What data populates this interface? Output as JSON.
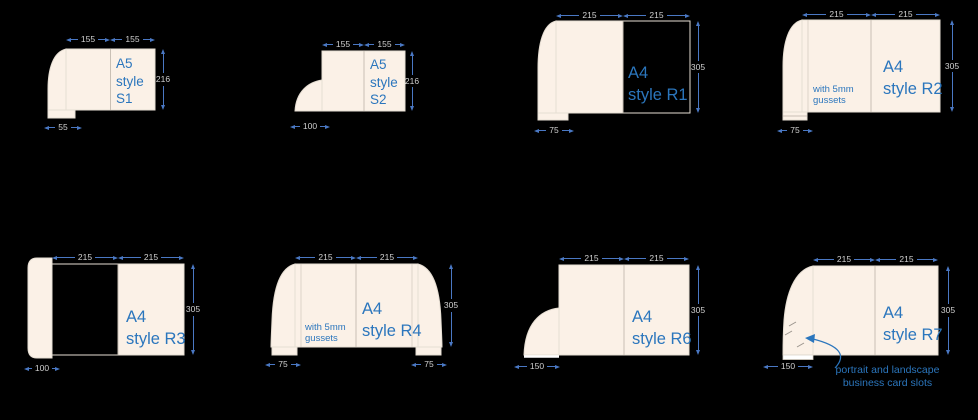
{
  "title": "presentation folder style diagrams",
  "colors": {
    "background": "#000000",
    "panel_fill": "#fbf1e7",
    "panel_outline": "#e6ded3",
    "label_text": "#2b76bd",
    "dimension_line": "#4a78c4",
    "dimension_text": "#d0d0d0"
  },
  "diagrams": [
    {
      "id": "S1",
      "label_lines": [
        "A5",
        "style",
        "S1"
      ],
      "top_dims": [
        "155",
        "155"
      ],
      "height_dim": "216",
      "bottom_dims": [
        "55"
      ]
    },
    {
      "id": "S2",
      "label_lines": [
        "A5",
        "style",
        "S2"
      ],
      "top_dims": [
        "155",
        "155"
      ],
      "height_dim": "216",
      "bottom_dims": [
        "100"
      ]
    },
    {
      "id": "R1",
      "label_lines": [
        "A4",
        "style R1"
      ],
      "top_dims": [
        "215",
        "215"
      ],
      "height_dim": "305",
      "bottom_dims": [
        "75"
      ]
    },
    {
      "id": "R2",
      "label_lines": [
        "A4",
        "style R2"
      ],
      "top_dims": [
        "215",
        "215"
      ],
      "height_dim": "305",
      "bottom_dims": [
        "75"
      ],
      "note_lines": [
        "with 5mm",
        "gussets"
      ]
    },
    {
      "id": "R3",
      "label_lines": [
        "A4",
        "style R3"
      ],
      "top_dims": [
        "215",
        "215"
      ],
      "height_dim": "305",
      "bottom_dims": [
        "100"
      ]
    },
    {
      "id": "R4",
      "label_lines": [
        "A4",
        "style R4"
      ],
      "top_dims": [
        "215",
        "215"
      ],
      "height_dim": "305",
      "bottom_dims": [
        "75",
        "75"
      ],
      "note_lines": [
        "with 5mm",
        "gussets"
      ]
    },
    {
      "id": "R6",
      "label_lines": [
        "A4",
        "style R6"
      ],
      "top_dims": [
        "215",
        "215"
      ],
      "height_dim": "305",
      "bottom_dims": [
        "150"
      ]
    },
    {
      "id": "R7",
      "label_lines": [
        "A4",
        "style R7"
      ],
      "top_dims": [
        "215",
        "215"
      ],
      "height_dim": "305",
      "bottom_dims": [
        "150"
      ],
      "caption_lines": [
        "portrait and landscape",
        "business card slots"
      ]
    }
  ]
}
